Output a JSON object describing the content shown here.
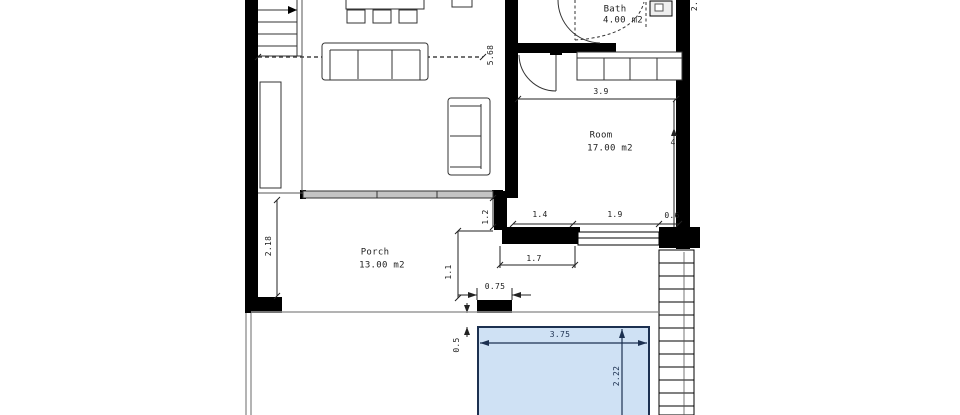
{
  "plan": {
    "rooms": {
      "bath": {
        "name": "Bath",
        "area": "4.00 m2"
      },
      "room": {
        "name": "Room",
        "area": "17.00 m2"
      },
      "porch": {
        "name": "Porch",
        "area": "13.00 m2"
      }
    },
    "dims": {
      "living_width": "5.68",
      "room_width": "3.9",
      "room_depth": "4",
      "win_seg_a": "1.4",
      "win_seg_b": "1.9",
      "win_seg_c": "0.6",
      "porch_opening": "1.7",
      "wall_offset": "1.2",
      "porch_depth": "2.18",
      "stub_offset": "1.1",
      "pillar_width": "0.75",
      "pool_gap": "0.5",
      "pool_width": "3.75",
      "pool_depth": "2.22",
      "edge_partial": "2."
    },
    "colors": {
      "wall": "#000000",
      "pool_fill": "#cfe1f4",
      "pool_border": "#1c3050",
      "terrace_line": "#9a9a9a"
    }
  }
}
